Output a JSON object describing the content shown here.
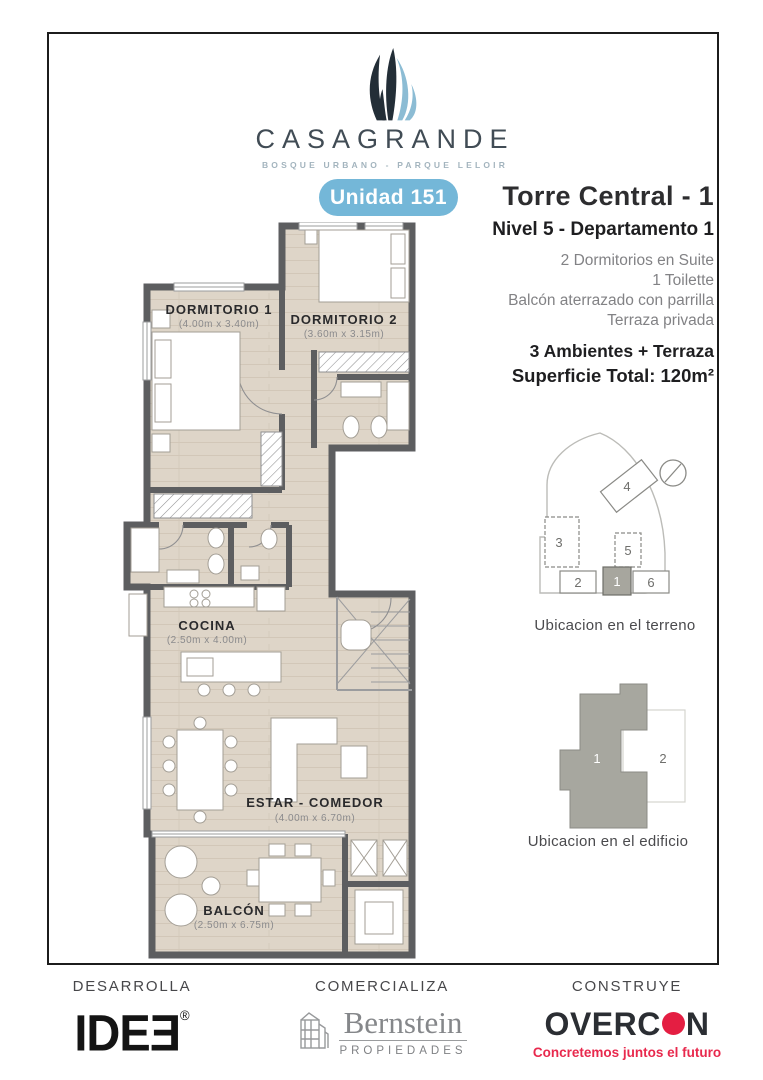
{
  "brand": {
    "name": "CASAGRANDE",
    "tagline": "BOSQUE URBANO - PARQUE LELOIR",
    "badge": "Unidad 151"
  },
  "info": {
    "title": "Torre Central - 1",
    "subtitle": "Nivel 5 - Departamento 1",
    "features": [
      "2 Dormitorios en Suite",
      "1 Toilette",
      "Balcón aterrazado con parrilla",
      "Terraza privada"
    ],
    "line1": "3 Ambientes + Terraza",
    "line2": "Superficie Total: 120m²"
  },
  "floorplan": {
    "rooms": {
      "dorm1": {
        "name": "DORMITORIO 1",
        "dims": "(4.00m x 3.40m)"
      },
      "dorm2": {
        "name": "DORMITORIO 2",
        "dims": "(3.60m x 3.15m)"
      },
      "cocina": {
        "name": "COCINA",
        "dims": "(2.50m x 4.00m)"
      },
      "estar": {
        "name": "ESTAR - COMEDOR",
        "dims": "(4.00m x 6.70m)"
      },
      "balcon": {
        "name": "BALCÓN",
        "dims": "(2.50m x 6.75m)"
      }
    }
  },
  "site": {
    "caption": "Ubicacion en el terreno",
    "labels": {
      "b1": "1",
      "b2": "2",
      "b3": "3",
      "b4": "4",
      "b5": "5",
      "b6": "6"
    }
  },
  "building": {
    "caption": "Ubicacion en el edificio",
    "units": {
      "u1": "1",
      "u2": "2"
    }
  },
  "footer": {
    "col1": {
      "role": "DESARROLLA",
      "logo": "IDEƎ",
      "reg": "®"
    },
    "col2": {
      "role": "COMERCIALIZA",
      "logo": "Bernstein",
      "sub": "PROPIEDADES"
    },
    "col3": {
      "role": "CONSTRUYE",
      "logo_a": "OVERC",
      "logo_b": "N",
      "tagline": "Concretemos juntos el futuro"
    }
  },
  "colors": {
    "badge_blue": "#74b7d8",
    "leaf_dark": "#232e37",
    "leaf_blue": "#8cbcd4",
    "wall_gray": "#5d5e60",
    "floor_beige": "#ded5c8",
    "overcon_red": "#e41e42",
    "text_dark": "#1e1e20",
    "text_gray": "#828285"
  }
}
